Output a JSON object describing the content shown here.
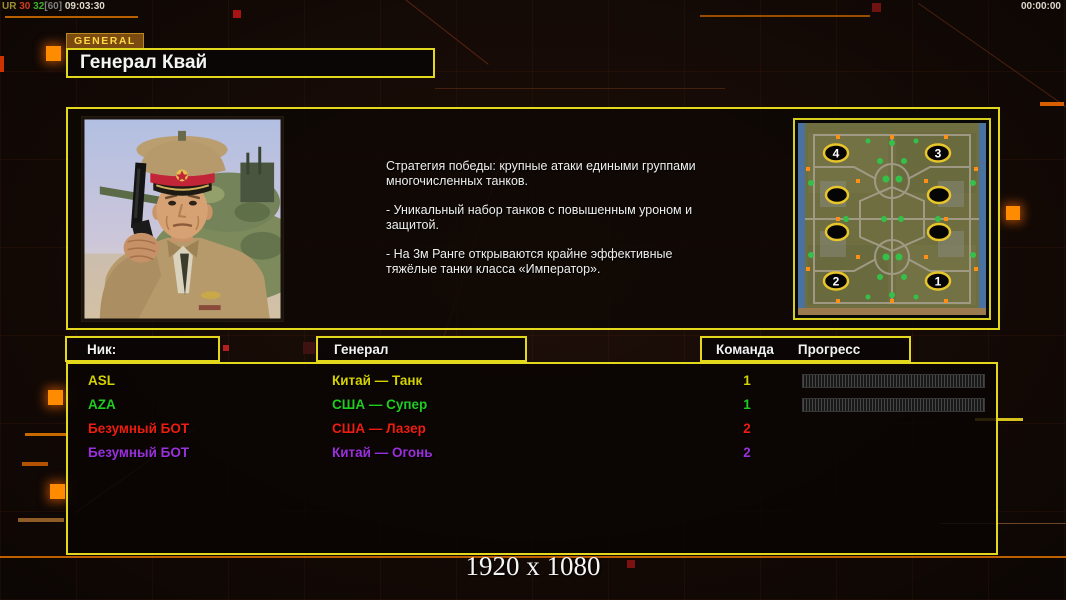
{
  "hud": {
    "perf_parts": [
      {
        "text": "UR ",
        "color": "#9f8f2f"
      },
      {
        "text": "30 ",
        "color": "#cf3f1f"
      },
      {
        "text": "32",
        "color": "#3fae2f"
      },
      {
        "text": "[60] ",
        "color": "#7f7f7f"
      },
      {
        "text": "09:03:30",
        "color": "#ded9cb"
      }
    ],
    "clock": "00:00:00",
    "resolution_label": "1920 x 1080"
  },
  "header": {
    "tab_label": "GENERAL",
    "title": "Генерал Квай"
  },
  "bio": {
    "paragraphs": [
      "Стратегия победы: крупные атаки едиными группами многочисленных танков.",
      "- Уникальный набор танков с повышенным уроном и защитой.",
      "- На 3м Ранге открываются крайне эффективные тяжёлые танки класса «Император»."
    ]
  },
  "map_preview": {
    "start_positions": [
      "4",
      "3",
      "2",
      "1"
    ]
  },
  "table": {
    "headers": {
      "nick": "Ник:",
      "general": "Генерал",
      "team": "Команда",
      "progress": "Прогресс"
    },
    "rows": [
      {
        "nick": "ASL",
        "general": "Китай — Танк",
        "team": "1",
        "color": "#d6d200",
        "has_progress": true
      },
      {
        "nick": "AZA",
        "general": "США — Супер",
        "team": "1",
        "color": "#21cc21",
        "has_progress": true
      },
      {
        "nick": "Безумный БОТ",
        "general": "США — Лазер",
        "team": "2",
        "color": "#ee1d10",
        "has_progress": false
      },
      {
        "nick": "Безумный БОТ",
        "general": "Китай — Огонь",
        "team": "2",
        "color": "#9b2fdd",
        "has_progress": false
      }
    ]
  },
  "colors": {
    "accent_yellow": "#e3d81b",
    "accent_orange": "#bf6000",
    "tab_background": "#7b4a10"
  }
}
